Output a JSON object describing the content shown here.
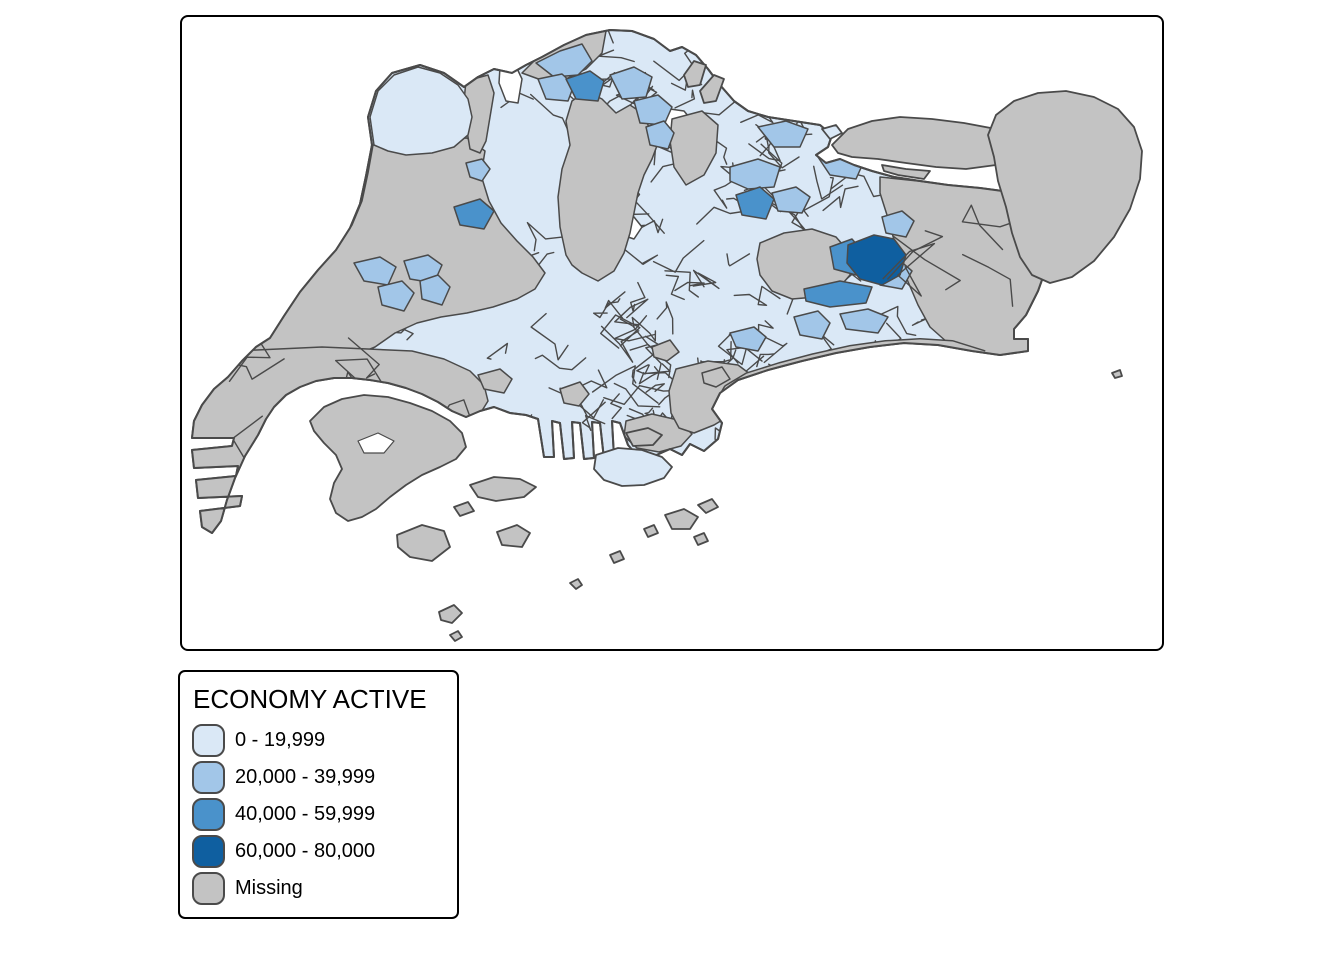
{
  "figure": {
    "type": "choropleth-map",
    "subject": "Singapore subzones",
    "background": "#FFFFFF",
    "frame_border": "#000000"
  },
  "colors": {
    "class1": "#DAE8F6",
    "class2": "#A2C6E8",
    "class3": "#4A92CB",
    "class4": "#0F5FA0",
    "missing": "#C3C3C3",
    "border": "#4A4A4A",
    "water": "#FFFFFF",
    "frame": "#000000",
    "text": "#000000"
  },
  "legend": {
    "title": "ECONOMY ACTIVE",
    "items": [
      {
        "label": "0 - 19,999",
        "color_key": "class1"
      },
      {
        "label": "20,000 - 39,999",
        "color_key": "class2"
      },
      {
        "label": "40,000 - 59,999",
        "color_key": "class3"
      },
      {
        "label": "60,000 - 80,000",
        "color_key": "class4"
      },
      {
        "label": "Missing",
        "color_key": "missing"
      }
    ]
  },
  "chart_data": {
    "type": "choropleth",
    "title": "ECONOMY ACTIVE",
    "classes": [
      {
        "range": "0 - 19,999",
        "color": "#DAE8F6"
      },
      {
        "range": "20,000 - 39,999",
        "color": "#A2C6E8"
      },
      {
        "range": "40,000 - 59,999",
        "color": "#4A92CB"
      },
      {
        "range": "60,000 - 80,000",
        "color": "#0F5FA0"
      },
      {
        "range": "Missing",
        "color": "#C3C3C3"
      }
    ],
    "legend_position": "bottom-left-outside"
  },
  "map": {
    "viewbox": "0 0 980 632",
    "mesh_seed": 20240613,
    "island": "190,128 186,100 194,74 210,56 238,48 262,56 282,70 296,60 312,52 330,56 344,48 360,40 382,28 404,18 428,13 450,14 472,22 488,34 500,30 514,38 526,52 538,68 552,84 566,94 586,100 612,104 638,108 650,118 646,130 634,138 644,146 658,142 672,148 690,154 712,160 738,164 766,168 798,171 828,175 852,183 866,197 872,218 866,246 856,274 844,298 832,312 832,322 846,322 846,334 818,338 790,334 756,328 722,326 688,330 654,336 620,344 586,353 556,363 538,376 530,392 540,406 536,422 522,434 508,427 500,438 488,432 470,440 458,442 446,428 438,406 430,404 432,440 422,442 418,406 410,405 412,441 402,442 398,406 390,405 392,441 382,442 378,406 370,404 372,440 362,440 356,402 344,398 328,396 312,390 298,394 284,400 270,394 256,385 240,377 224,371 206,366 188,363 170,361 152,361 134,364 118,370 104,378 92,390 84,402 76,418 63,439 53,461 45,483 39,504 30,516 20,510 18,494 58,489 60,479 16,481 14,463 54,459 56,449 12,451 10,433 50,429 52,421 10,421 12,404 20,388 32,372 46,360 60,344 74,330 88,321 102,299 118,275 136,253 154,233 168,211 178,187 184,159",
    "lakes": [
      {
        "name": "kranji-reservoir",
        "pts": "318,50 332,45 340,62 336,86 324,84 317,66"
      },
      {
        "name": "seletar-inlet",
        "pts": "474,90 502,94 512,106 492,116 476,104"
      },
      {
        "name": "upper-pierce-reservoir",
        "pts": "412,168 432,162 442,172 434,186 418,182"
      },
      {
        "name": "macritchie-reservoir",
        "pts": "436,206 452,200 460,210 452,222 440,218"
      }
    ],
    "regions": [
      {
        "name": "western-water-catchment",
        "cls": "missing",
        "pts": "60,342 74,328 90,318 104,296 120,272 138,250 156,230 170,208 180,184 186,156 191,128 240,124 285,121 303,134 299,158 307,184 319,206 335,224 351,240 363,256 353,272 335,282 311,290 285,296 259,300 235,306 213,316 193,330 169,340 141,346 109,350 81,350"
      },
      {
        "name": "tuas-industrial",
        "cls": "missing",
        "pts": "8,336 140,330 230,334 262,342 288,354 302,368 306,384 296,400 278,414 256,428 232,442 206,456 180,468 152,480 120,492 86,504 48,516 10,522"
      },
      {
        "name": "sungei-kadut",
        "cls": "missing",
        "pts": "284,64 306,58 312,76 308,100 304,124 298,136 288,132 284,108 282,84"
      },
      {
        "name": "central-catchment-mandai",
        "cls": "missing",
        "pts": "384,238 378,210 376,180 380,152 388,128 384,104 390,84 404,74 420,82 434,96 448,88 460,96 468,112 476,126 470,142 462,158 456,176 452,196 448,216 442,236 432,254 416,264 400,256 390,248"
      },
      {
        "name": "senoko-north",
        "cls": "missing",
        "pts": "340,56 356,40 378,28 402,18 424,14 420,36 404,52 384,62 362,64"
      },
      {
        "name": "seletar-airport",
        "cls": "missing",
        "pts": "490,102 520,94 536,108 534,136 522,158 504,168 492,150 488,124"
      },
      {
        "name": "paya-lebar-airbase",
        "cls": "missing",
        "pts": "578,226 602,216 630,212 654,220 668,236 668,258 656,272 634,280 610,282 590,274 578,258 575,242"
      },
      {
        "name": "changi-airport-east",
        "cls": "missing",
        "pts": "698,160 736,164 766,168 798,171 828,175 852,183 866,197 872,218 866,246 856,274 844,298 832,312 832,322 846,322 846,334 818,338 790,334 766,326 748,310 736,288 724,260 714,230 705,198 698,176"
      },
      {
        "name": "keppel-port",
        "cls": "missing",
        "pts": "444,404 470,397 496,403 510,417 499,429 477,435 455,431 442,419"
      },
      {
        "name": "marina-east",
        "cls": "missing",
        "pts": "494,352 526,344 556,348 572,360 568,380 552,396 532,408 512,416 497,411 489,396 487,374"
      },
      {
        "name": "alexandra-patch",
        "cls": "missing",
        "pts": "378,372 398,365 407,377 397,389 382,386"
      },
      {
        "name": "cbd-patch-a",
        "cls": "missing",
        "pts": "470,330 488,323 497,335 485,344 472,340"
      },
      {
        "name": "cbd-patch-b",
        "cls": "missing",
        "pts": "520,356 540,350 548,362 534,370 522,366"
      },
      {
        "name": "pandan-patch",
        "cls": "missing",
        "pts": "296,358 318,352 330,362 322,376 302,372"
      },
      {
        "name": "lim-chu-kang",
        "cls": "class1",
        "pts": "192,128 188,100 196,74 212,58 236,50 258,56 276,68 286,82 290,100 286,118 272,130 250,136 224,138 206,134"
      },
      {
        "name": "woodlands-a",
        "cls": "class2",
        "pts": "354,46 378,34 400,27 410,44 396,58 372,60"
      },
      {
        "name": "woodlands-b",
        "cls": "class2",
        "pts": "356,62 380,57 392,68 386,84 364,82"
      },
      {
        "name": "yishun-a",
        "cls": "class2",
        "pts": "428,58 452,50 470,60 464,80 440,82"
      },
      {
        "name": "yishun-b",
        "cls": "class2",
        "pts": "452,84 476,78 490,90 482,108 458,106"
      },
      {
        "name": "yishun-c",
        "cls": "class2",
        "pts": "464,110 482,104 492,116 486,132 468,128"
      },
      {
        "name": "sengkang",
        "cls": "class2",
        "pts": "548,150 576,142 598,150 592,170 566,172 548,164"
      },
      {
        "name": "punggol",
        "cls": "class2",
        "pts": "576,110 604,104 626,112 618,130 592,130"
      },
      {
        "name": "serangoon-north",
        "cls": "class2",
        "pts": "590,176 614,170 628,180 620,196 596,194"
      },
      {
        "name": "pasir-ris-west",
        "cls": "class2",
        "pts": "636,140 662,134 682,144 674,162 648,158"
      },
      {
        "name": "tampines-north",
        "cls": "class2",
        "pts": "700,200 720,194 732,204 724,220 704,216"
      },
      {
        "name": "tampines-east-band",
        "cls": "class2",
        "pts": "690,248 716,242 730,254 720,272 698,268"
      },
      {
        "name": "bedok-reservoir",
        "cls": "class2",
        "pts": "658,297 686,292 706,300 696,316 664,312"
      },
      {
        "name": "geylang-east",
        "cls": "class2",
        "pts": "548,316 572,310 584,320 576,334 554,330"
      },
      {
        "name": "jurong-west-a",
        "cls": "class2",
        "pts": "172,246 198,240 214,250 206,268 182,264"
      },
      {
        "name": "jurong-west-b",
        "cls": "class2",
        "pts": "222,244 246,238 260,248 252,266 228,262"
      },
      {
        "name": "jurong-west-c",
        "cls": "class2",
        "pts": "238,264 256,258 268,270 260,288 240,282"
      },
      {
        "name": "boon-lay",
        "cls": "class2",
        "pts": "196,270 220,264 232,276 222,294 200,288"
      },
      {
        "name": "kranji-sw",
        "cls": "class2",
        "pts": "284,146 300,142 308,152 300,164 288,160"
      },
      {
        "name": "siglap",
        "cls": "class2",
        "pts": "612,300 636,294 648,306 640,322 618,318"
      },
      {
        "name": "woodlands-east-3",
        "cls": "class3",
        "pts": "384,62 408,54 422,64 416,84 394,82"
      },
      {
        "name": "hougang-3",
        "cls": "class3",
        "pts": "554,178 578,170 592,182 584,202 560,198"
      },
      {
        "name": "brickland-3",
        "cls": "class3",
        "pts": "272,190 298,182 312,194 302,212 278,208"
      },
      {
        "name": "tampines-west-3",
        "cls": "class3",
        "pts": "648,230 670,222 682,236 674,258 652,252"
      },
      {
        "name": "bedok-north-3",
        "cls": "class3",
        "pts": "622,272 658,264 690,270 684,286 648,290 624,284"
      },
      {
        "name": "tampines-dark-4",
        "cls": "class4",
        "pts": "666,228 692,218 712,222 724,238 718,258 700,268 678,262 665,246"
      }
    ],
    "coast_band": {
      "name": "east-coast-park-band",
      "pts_line": "802,338 770,328 738,326 704,328 668,333 632,341 598,350 566,360 546,372 538,386 544,400"
    },
    "islands": [
      {
        "name": "jurong-island",
        "cls": "missing",
        "pts": "128,404 142,390 160,382 182,378 206,380 228,386 250,394 268,404 280,416 284,430 274,442 258,450 240,458 224,468 208,480 194,492 180,500 166,504 154,496 148,482 152,466 160,452 154,438 142,426 132,414"
      },
      {
        "name": "jurong-island-lagoon",
        "cls": "water",
        "pts": "176,424 196,416 212,424 202,436 182,436"
      },
      {
        "name": "sentosa",
        "cls": "class1",
        "pts": "414,438 436,431 460,433 480,440 490,450 482,461 462,468 440,469 422,463 412,452"
      },
      {
        "name": "pulau-brani",
        "cls": "missing",
        "pts": "444,416 466,411 480,418 471,428 451,429"
      },
      {
        "name": "pulau-ubin",
        "cls": "missing",
        "pts": "650,128 666,112 690,104 718,100 750,102 782,106 814,112 842,118 864,126 878,136 866,146 842,150 814,148 784,152 754,150 724,146 696,142 670,140 656,136"
      },
      {
        "name": "pulau-ketam",
        "cls": "missing",
        "pts": "700,148 724,152 748,154 742,162 716,158 702,154"
      },
      {
        "name": "pulau-tekong",
        "cls": "missing",
        "pts": "812,140 806,118 814,98 832,84 856,76 884,74 912,80 936,92 952,110 960,134 958,162 948,192 932,220 912,244 890,260 868,266 850,258 838,240 830,216 824,190 816,164"
      },
      {
        "name": "punggol-barat-islet",
        "cls": "missing",
        "pts": "502,58 512,44 524,48 518,68 506,70"
      },
      {
        "name": "punggol-timor-islet",
        "cls": "missing",
        "pts": "518,74 532,58 542,62 534,84 522,86"
      },
      {
        "name": "coney-island",
        "cls": "class1",
        "pts": "640,112 654,108 660,116 648,122"
      },
      {
        "name": "st-johns-island",
        "cls": "missing",
        "pts": "483,498 502,492 516,500 508,512 490,512"
      },
      {
        "name": "lazarus-island",
        "cls": "missing",
        "pts": "516,488 530,482 536,490 524,496"
      },
      {
        "name": "kusu-island",
        "cls": "missing",
        "pts": "512,520 522,516 526,524 516,528"
      },
      {
        "name": "sisters-islands",
        "cls": "missing",
        "pts": "462,512 472,508 476,516 466,520"
      },
      {
        "name": "pulau-jong",
        "cls": "missing",
        "pts": "428,538 438,534 442,542 432,546"
      },
      {
        "name": "pulau-bukom",
        "cls": "missing",
        "pts": "288,468 312,460 338,462 354,470 342,480 314,484 296,480"
      },
      {
        "name": "bukom-kechil",
        "cls": "missing",
        "pts": "272,490 286,485 292,494 278,499"
      },
      {
        "name": "pulau-semakau",
        "cls": "missing",
        "pts": "215,518 240,508 262,514 268,530 250,544 228,540 216,530"
      },
      {
        "name": "pulau-sebarok",
        "cls": "missing",
        "pts": "315,515 335,508 348,516 340,530 320,528"
      },
      {
        "name": "islet-south-a",
        "cls": "missing",
        "pts": "257,595 272,588 280,596 270,606 259,603"
      },
      {
        "name": "islet-south-b",
        "cls": "missing",
        "pts": "268,618 276,614 280,620 273,624"
      },
      {
        "name": "islet-south-c",
        "cls": "missing",
        "pts": "388,566 396,562 400,568 394,572"
      },
      {
        "name": "islet-east-speck",
        "cls": "missing",
        "pts": "930,356 938,353 940,359 933,361"
      }
    ],
    "mesh": [
      {
        "name": "mesh-north",
        "x": 348,
        "y": 16,
        "w": 190,
        "h": 110,
        "n": 14,
        "step": 26,
        "above": false
      },
      {
        "name": "mesh-yishun",
        "x": 426,
        "y": 42,
        "w": 88,
        "h": 96,
        "n": 8,
        "step": 20,
        "above": false
      },
      {
        "name": "mesh-northeast",
        "x": 516,
        "y": 100,
        "w": 140,
        "h": 112,
        "n": 14,
        "step": 24,
        "above": false
      },
      {
        "name": "mesh-east",
        "x": 600,
        "y": 136,
        "w": 148,
        "h": 176,
        "n": 16,
        "step": 26,
        "above": false
      },
      {
        "name": "mesh-cck-bukit-panjang",
        "x": 350,
        "y": 218,
        "w": 128,
        "h": 92,
        "n": 10,
        "step": 24,
        "above": false
      },
      {
        "name": "mesh-west-cluster",
        "x": 166,
        "y": 236,
        "w": 118,
        "h": 76,
        "n": 7,
        "step": 20,
        "above": false
      },
      {
        "name": "mesh-jurong-east",
        "x": 268,
        "y": 298,
        "w": 215,
        "h": 110,
        "n": 15,
        "step": 26,
        "above": false
      },
      {
        "name": "mesh-central-corridor",
        "x": 446,
        "y": 132,
        "w": 115,
        "h": 155,
        "n": 11,
        "step": 26,
        "above": false
      },
      {
        "name": "mesh-south-central",
        "x": 380,
        "y": 262,
        "w": 235,
        "h": 140,
        "n": 22,
        "step": 24,
        "above": false
      },
      {
        "name": "mesh-cbd",
        "x": 424,
        "y": 330,
        "w": 130,
        "h": 85,
        "n": 16,
        "step": 14,
        "above": false
      },
      {
        "name": "mesh-east-coast",
        "x": 548,
        "y": 300,
        "w": 195,
        "h": 60,
        "n": 9,
        "step": 24,
        "above": false
      },
      {
        "name": "mesh-tuas",
        "x": 18,
        "y": 338,
        "w": 285,
        "h": 175,
        "n": 11,
        "step": 34,
        "above": true
      },
      {
        "name": "mesh-changi",
        "x": 700,
        "y": 170,
        "w": 155,
        "h": 150,
        "n": 5,
        "step": 40,
        "above": true
      }
    ]
  }
}
